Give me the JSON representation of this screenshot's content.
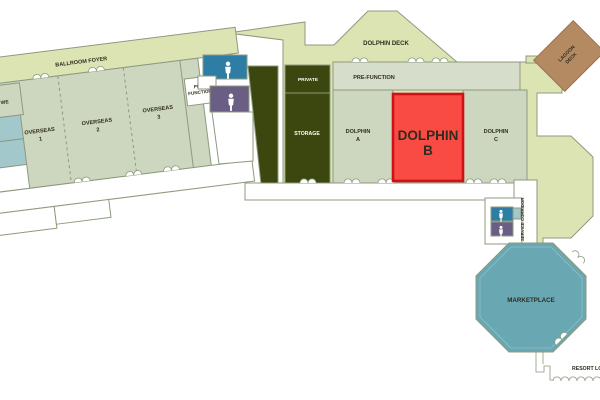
{
  "plan_title": "Resort convention level floor plan",
  "colors": {
    "sage": "#cdd7bf",
    "prefunction_sage": "#d6decb",
    "deck": "#dde4b4",
    "dark_green": "#3b470f",
    "white_room": "#ffffff",
    "outline": "#8d9a7e",
    "highlight_fill": "#f94b44",
    "highlight_border": "#cf1016",
    "restroom_blue": "#2e7da4",
    "restroom_purple": "#6b5e84",
    "small_room_teal": "#a2c8cc",
    "marketplace_teal": "#69a8b2",
    "lagoon_brown": "#b48a62",
    "label_dark": "#2f2c1e",
    "label_light": "#ffffff"
  },
  "rooms": {
    "ballroom_foyer": {
      "label": "BALLROOM FOYER"
    },
    "overseas_1": {
      "name": "OVERSEAS",
      "number": "1"
    },
    "overseas_2": {
      "name": "OVERSEAS",
      "number": "2"
    },
    "overseas_3": {
      "name": "OVERSEAS",
      "number": "3"
    },
    "pre_function_west": {
      "line1": "PRE-",
      "line2": "FUNCTION"
    },
    "partial_left_room": {
      "label": "WE"
    },
    "private": {
      "label": "PRIVATE"
    },
    "storage": {
      "label": "STORAGE"
    },
    "dolphin_deck": {
      "label": "DOLPHIN DECK"
    },
    "pre_function": {
      "label": "PRE-FUNCTION"
    },
    "dolphin_a": {
      "name": "DOLPHIN",
      "letter": "A"
    },
    "dolphin_b": {
      "name": "DOLPHIN",
      "letter": "B",
      "state": "highlighted"
    },
    "dolphin_c": {
      "name": "DOLPHIN",
      "letter": "C"
    },
    "lagoon_deck": {
      "line1": "LAGOON",
      "line2": "DECK"
    },
    "service_corridor": {
      "label": "SERVICE CORRIDOR"
    },
    "marketplace": {
      "label": "MARKETPLACE"
    },
    "resort_lobby": {
      "label": "RESORT LOBBY"
    }
  },
  "icons": {
    "men_restroom": "men-restroom-icon",
    "women_restroom": "women-restroom-icon"
  }
}
